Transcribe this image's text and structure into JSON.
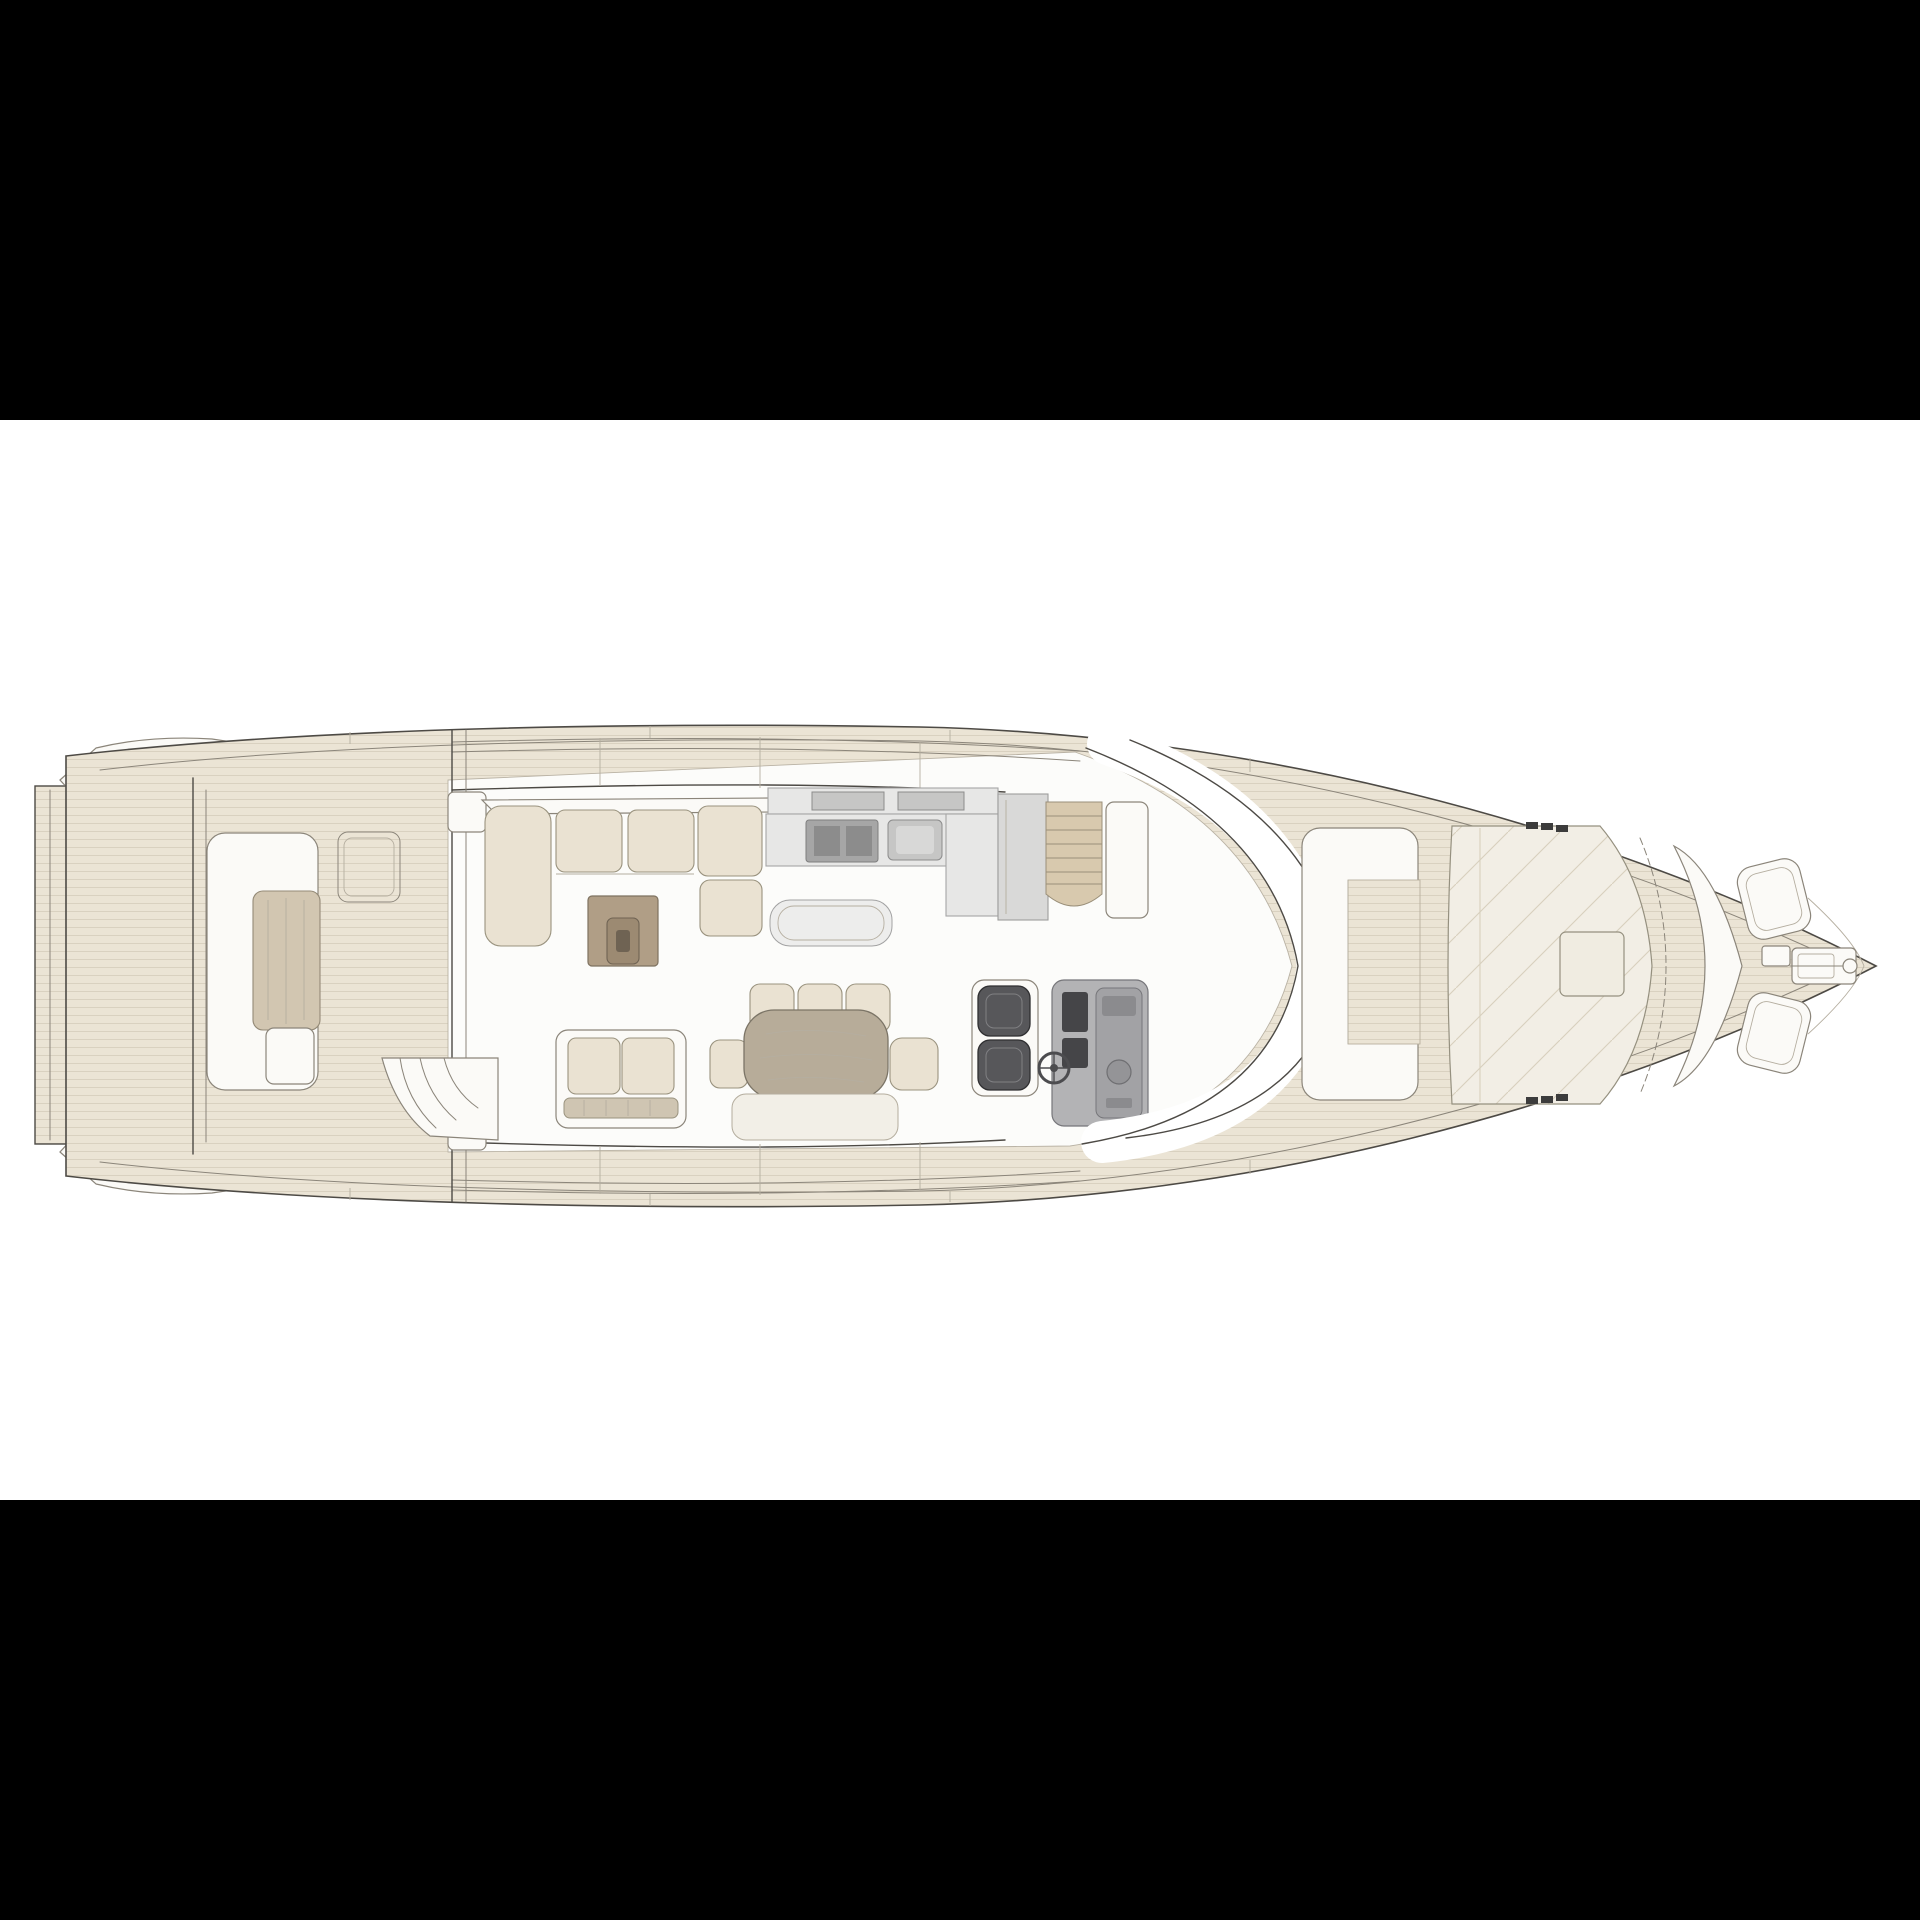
{
  "meta": {
    "title": "Motor yacht main deck floor plan (top view, bow to the right)",
    "aria_label": "Black-letterboxed technical drawing of a motor yacht main deck seen from above: swim platform and aft cockpit at left, open-plan salon with L-shaped sofa, coffee table, loveseat, dining table, galley, companionway stairs and twin-seat helm station amidships, curved windshield, and a foredeck lounge with C-bench, sun pad and anchor windlass toward the bow tip at right.",
    "visible_text": []
  },
  "colors": {
    "ink": "#4d4a45",
    "ink_soft": "#8b857a",
    "ink_faint": "#b5aea0",
    "deck": "#ebe4d5",
    "deck_line": "#d9d1c0",
    "floor": "#fcfcfa",
    "white": "#fbfaf7",
    "cushion": "#eae2d2",
    "wood": "#d2c6b1",
    "wood_dark": "#948a77",
    "table_top": "#b7ac99",
    "coffee": "#b09e86",
    "coffee_in": "#9c8a72",
    "coffee_dark": "#6f6353",
    "gray_1": "#e7e7e6",
    "gray_2": "#c6c6c5",
    "gray_3": "#a6a6a6",
    "gray_4": "#8c8c8c",
    "seat_dark": "#57575a",
    "console": "#b3b3b5",
    "stair": "#d8c9ae",
    "letterbox": "#000000",
    "background": "#ffffff"
  },
  "plan": {
    "orientation": "bow-right",
    "areas": [
      {
        "id": "swim-platform",
        "label": "Swim platform"
      },
      {
        "id": "stern-quarter-port",
        "label": "Port stern quarter"
      },
      {
        "id": "stern-quarter-starboard",
        "label": "Starboard stern quarter"
      },
      {
        "id": "aft-cockpit",
        "label": "Aft cockpit"
      },
      {
        "id": "aft-bench",
        "label": "Aft cockpit bench"
      },
      {
        "id": "aft-table",
        "label": "Aft cockpit table"
      },
      {
        "id": "aft-stairs",
        "label": "Cockpit steps to platform"
      },
      {
        "id": "deck-hatch",
        "label": "Deck hatch"
      },
      {
        "id": "salon",
        "label": "Open salon"
      },
      {
        "id": "l-sofa",
        "label": "L-shaped salon sofa"
      },
      {
        "id": "coffee-table",
        "label": "Coffee table"
      },
      {
        "id": "loveseat",
        "label": "Two-seat sofa"
      },
      {
        "id": "dining",
        "label": "Dining area with table and chairs"
      },
      {
        "id": "galley",
        "label": "Galley with cooktop and sink"
      },
      {
        "id": "bar-counter",
        "label": "Serving counter"
      },
      {
        "id": "stairway-down",
        "label": "Companionway stairs to lower deck"
      },
      {
        "id": "helm",
        "label": "Helm station with twin seats"
      },
      {
        "id": "windshield",
        "label": "Wraparound windshield"
      },
      {
        "id": "foredeck-lounge",
        "label": "Foredeck C-shaped lounge"
      },
      {
        "id": "sunpad",
        "label": "Bow sun pad"
      },
      {
        "id": "bow-lockers",
        "label": "Bow seat lockers"
      },
      {
        "id": "windlass",
        "label": "Anchor windlass"
      },
      {
        "id": "bow",
        "label": "Bow tip"
      }
    ]
  }
}
